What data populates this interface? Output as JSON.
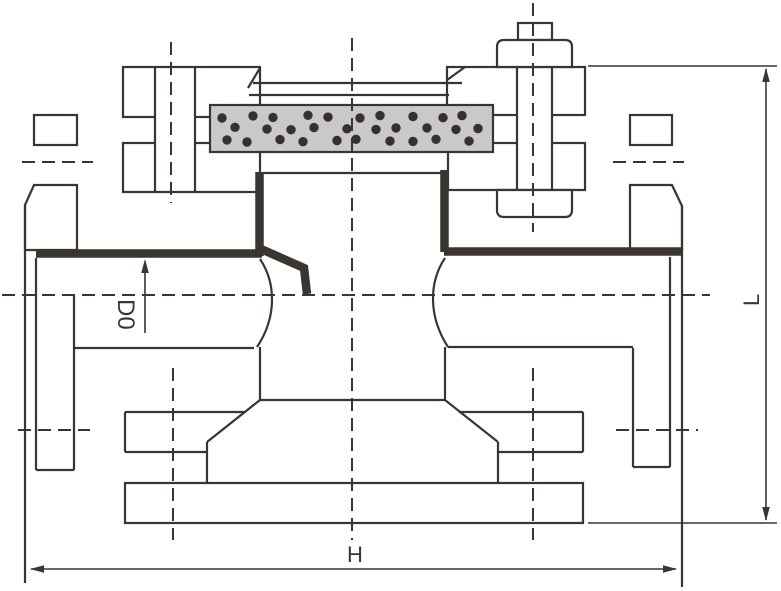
{
  "dimension_labels": {
    "d0": "D0",
    "h": "H",
    "l": "L"
  },
  "colors": {
    "line": "#3a3531",
    "band_fill": "#c9c9c9",
    "band_dot": "#38302b",
    "background": "#ffffff"
  }
}
